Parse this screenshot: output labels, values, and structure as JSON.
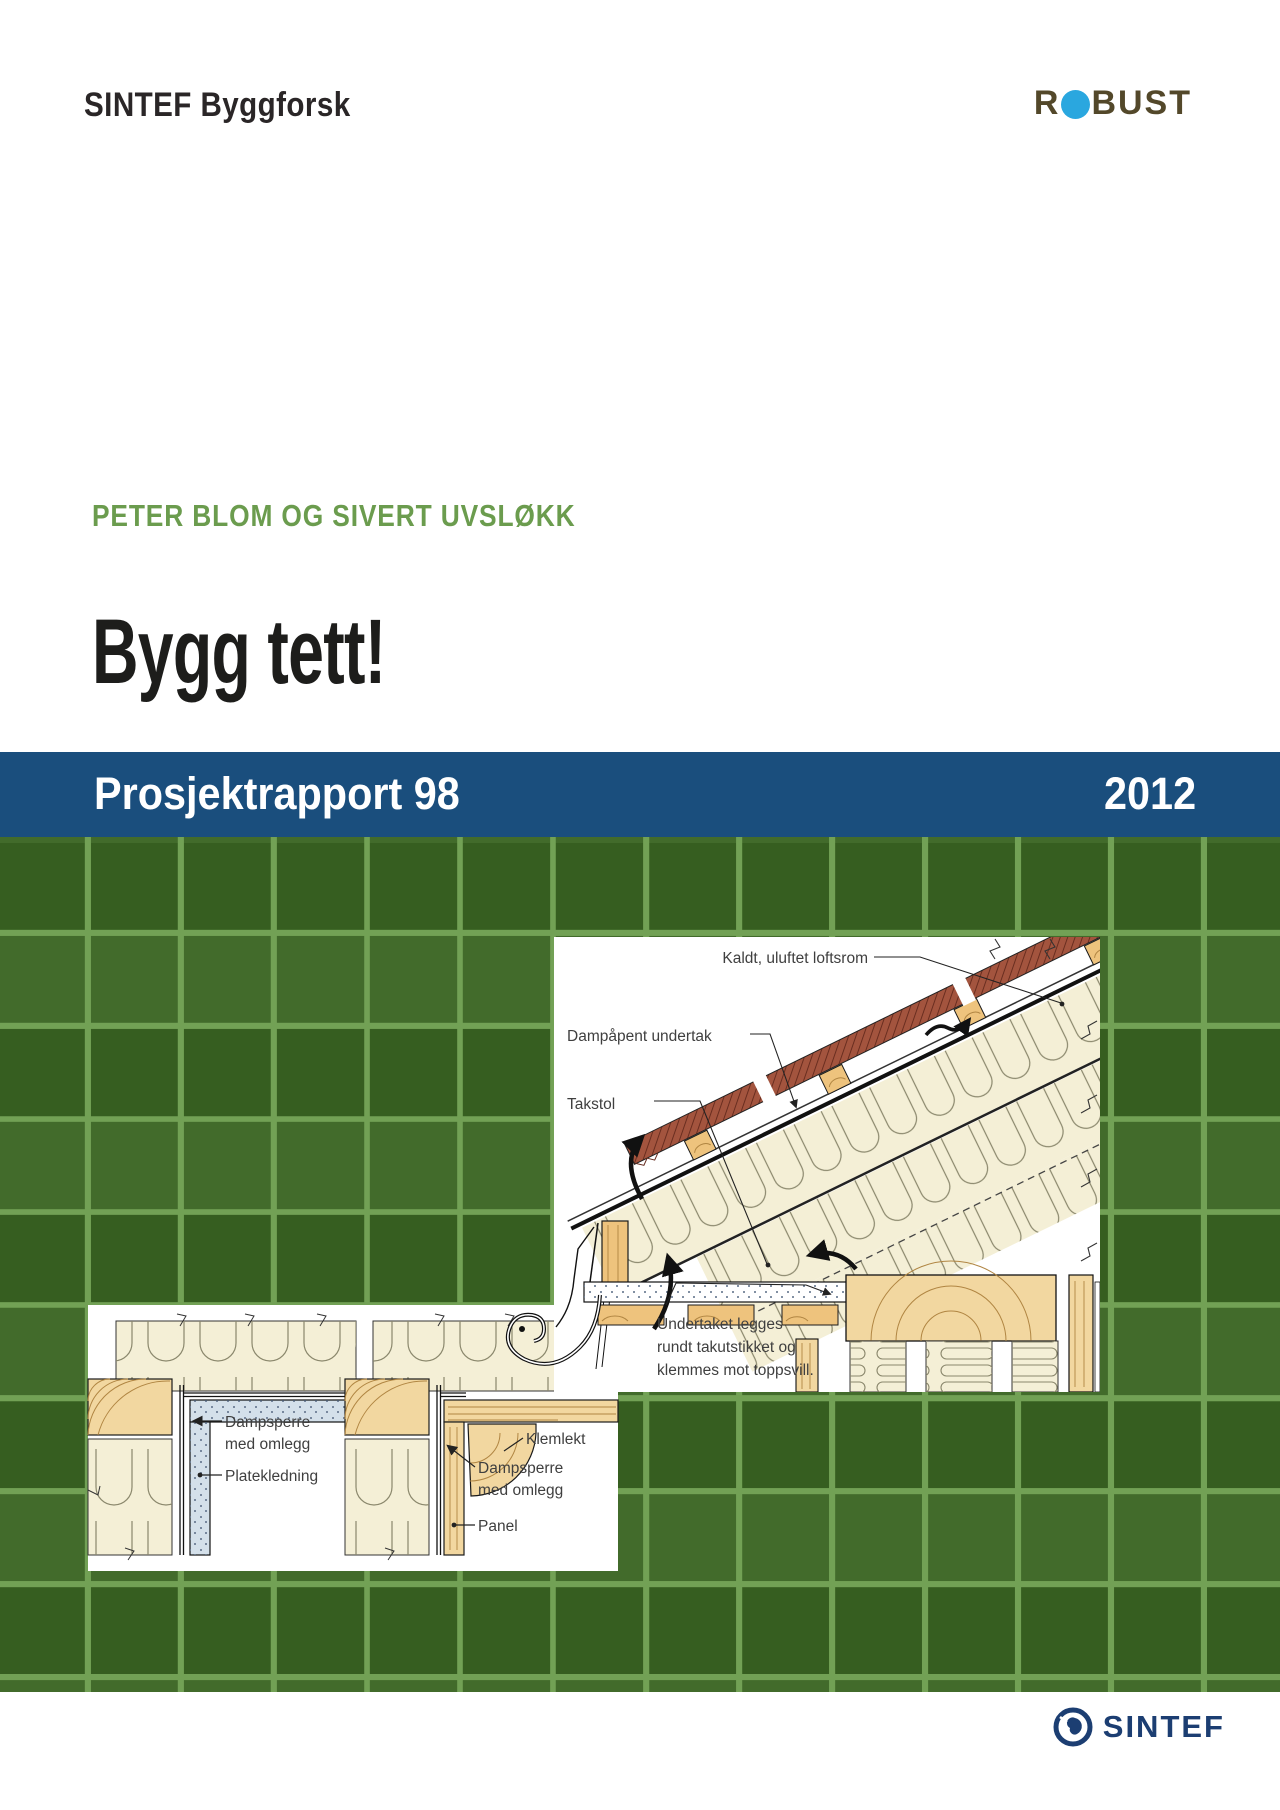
{
  "page": {
    "width": 1280,
    "height": 1810
  },
  "header": {
    "brand": "SINTEF Byggforsk",
    "robust": {
      "r": "R",
      "rest": "BUST",
      "dot_color": "#2aa7df",
      "text_color": "#53482a"
    }
  },
  "cover": {
    "authors": "PETER BLOM OG SIVERT UVSLØKK",
    "authors_color": "#6b9c4e",
    "title": "Bygg tett!"
  },
  "banner": {
    "left": "Prosjektrapport 98",
    "right": "2012",
    "bg_color": "#1a4e7d",
    "text_color": "#ffffff"
  },
  "background": {
    "tile_color": "#3a6522",
    "grout_color": "#72a155"
  },
  "diagram_roof": {
    "label_attic": "Kaldt, uluftet loftsrom",
    "label_membrane": "Dampåpent undertak",
    "label_truss": "Takstol",
    "note_line1": "Undertaket legges",
    "note_line2": "rundt takutstikket og",
    "note_line3": "klemmes mot toppsvill."
  },
  "diagram_walls": {
    "left_vapor_line1": "Dampsperre",
    "left_vapor_line2": "med omlegg",
    "left_board": "Platekledning",
    "right_klemlekt": "Klemlekt",
    "right_vapor_line1": "Dampsperre",
    "right_vapor_line2": "med omlegg",
    "right_panel": "Panel"
  },
  "footer": {
    "logo_text": "SINTEF",
    "logo_color": "#1c3e72"
  }
}
